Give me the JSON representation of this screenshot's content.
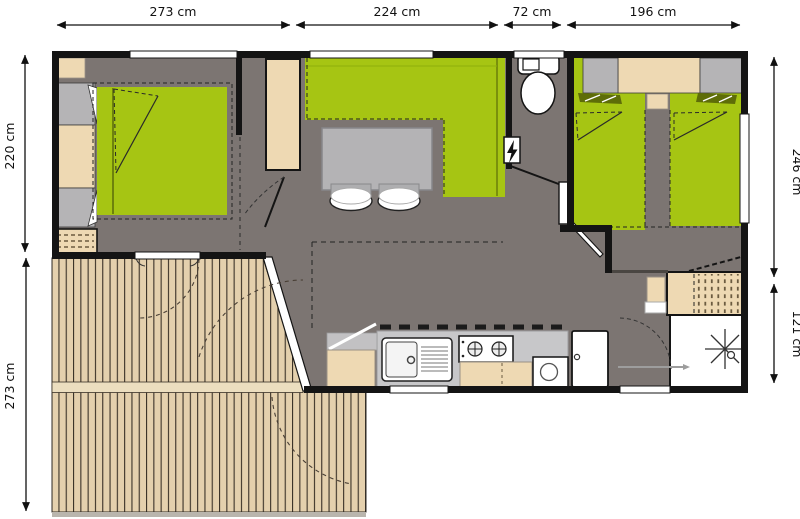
{
  "floorplan": {
    "dimensions": {
      "top": [
        "273 cm",
        "224 cm",
        "72 cm",
        "196 cm"
      ],
      "left": [
        "220 cm",
        "273 cm"
      ],
      "right": [
        "246 cm",
        "121 cm"
      ]
    },
    "colors": {
      "wall": "#141414",
      "floor_gray": "#7c7572",
      "furniture_green": "#a6c513",
      "blanket_olive": "#5e6d08",
      "wood_beige": "#eed9b3",
      "deck_plank": "#e4d0ad",
      "deck_band": "#ecdebf",
      "gray_furniture": "#b5b4b6",
      "counter_gray": "#c7c7c9",
      "fixture_white": "#ffffff"
    }
  }
}
